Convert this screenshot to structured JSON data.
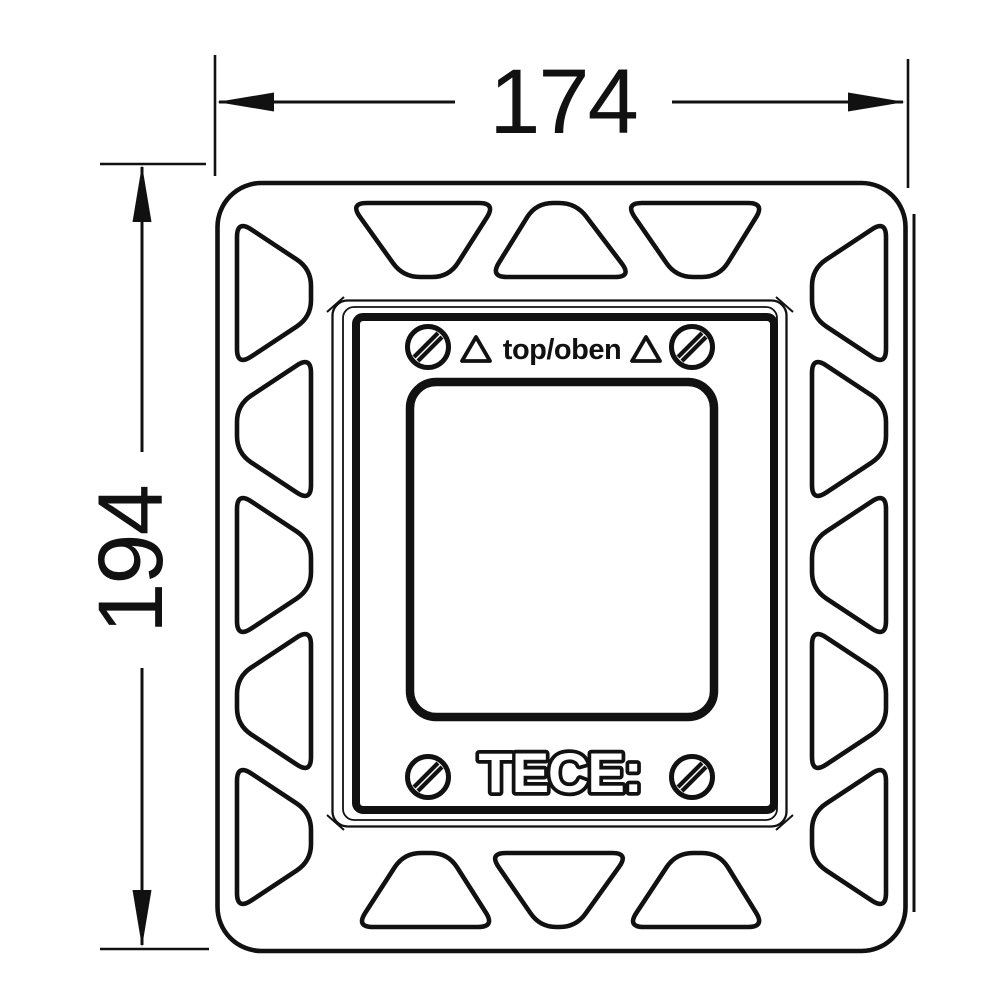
{
  "dimensions": {
    "width_label": "174",
    "height_label": "194"
  },
  "plate": {
    "orientation_label": "top/oben",
    "logo": "TECE:"
  },
  "icons": {
    "screw": "slotted-screw-icon",
    "orientation_marker": "triangle-up-icon",
    "dimension_arrow": "arrowhead-icon"
  },
  "colors": {
    "line": "#111111",
    "background": "#ffffff"
  }
}
